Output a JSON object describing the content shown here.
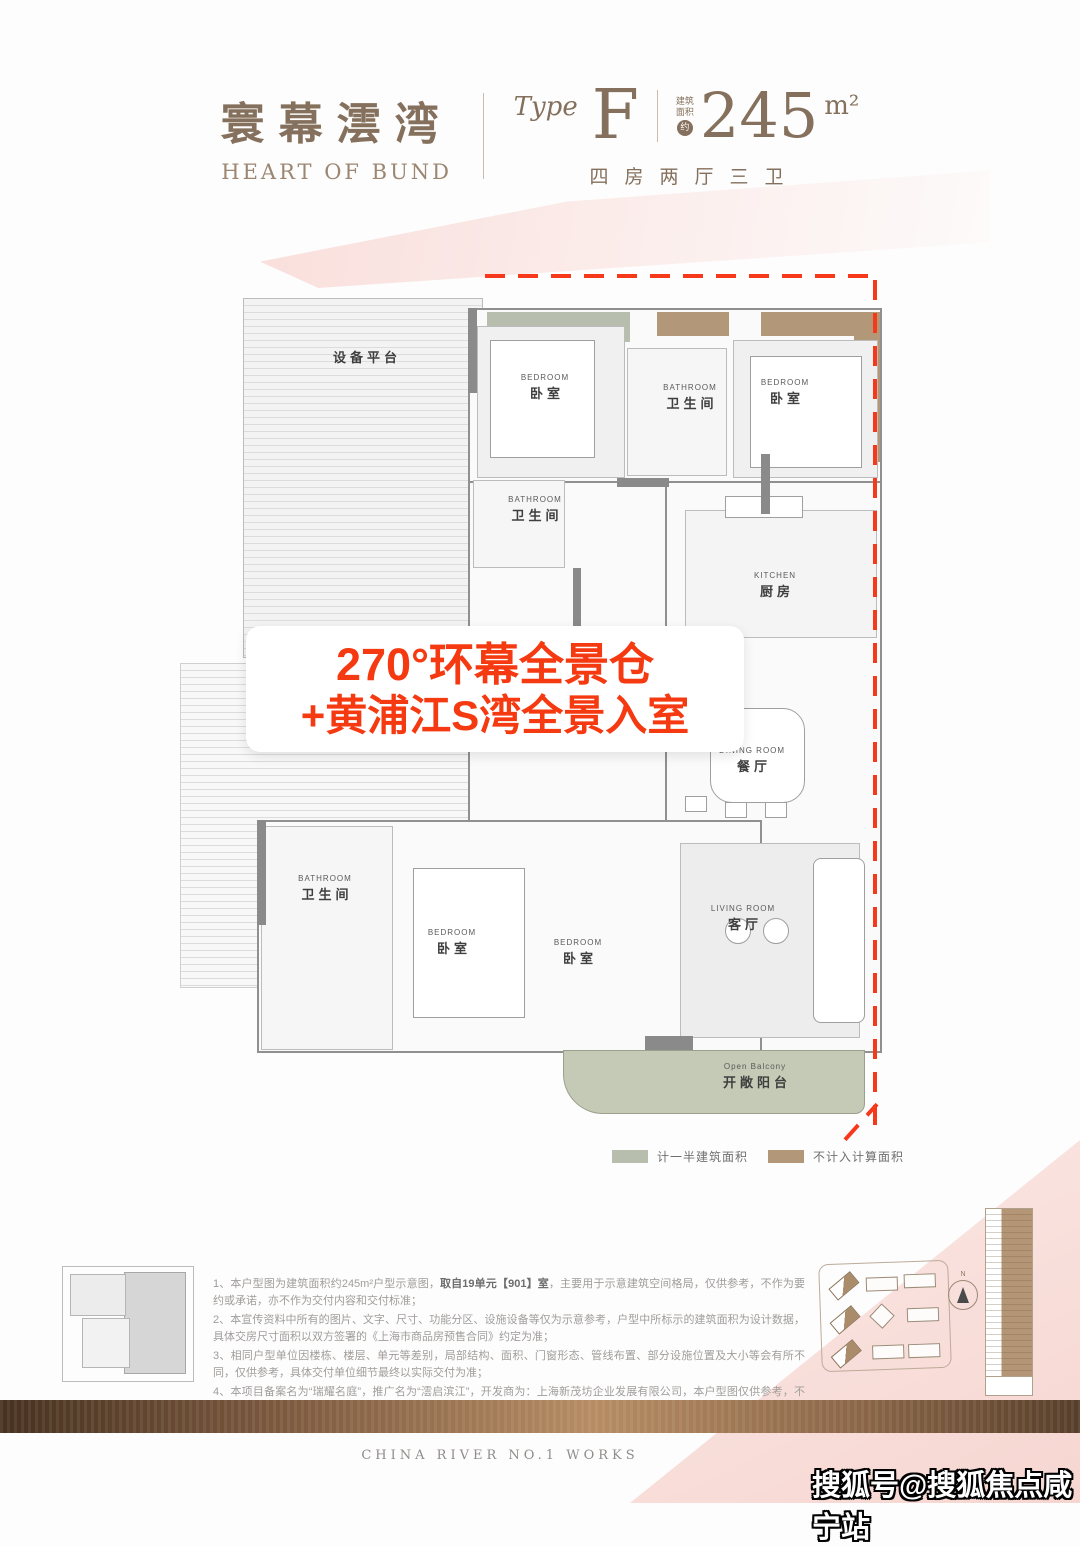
{
  "header": {
    "brand_cn": "寰幕澐湾",
    "brand_en": "HEART OF BUND",
    "type_label": "Type",
    "type_value": "F",
    "area_label_1": "建筑",
    "area_label_2": "面积",
    "area_approx": "约",
    "area_number": "245",
    "area_unit": "m²",
    "layout": "四房两厅三卫"
  },
  "banner": {
    "line1": "270°环幕全景仓",
    "line2": "+黄浦江S湾全景入室"
  },
  "floorplan": {
    "equipment_platform": "设备平台",
    "rooms": [
      {
        "id": "bedroom-top-left",
        "en": "BEDROOM",
        "cn": "卧室"
      },
      {
        "id": "bathroom-top",
        "en": "BATHROOM",
        "cn": "卫生间"
      },
      {
        "id": "bedroom-top-right",
        "en": "BEDROOM",
        "cn": "卧室"
      },
      {
        "id": "bathroom-mid",
        "en": "BATHROOM",
        "cn": "卫生间"
      },
      {
        "id": "kitchen",
        "en": "KITCHEN",
        "cn": "厨房"
      },
      {
        "id": "dining-room",
        "en": "DINING ROOM",
        "cn": "餐厅"
      },
      {
        "id": "living-room",
        "en": "LIVING ROOM",
        "cn": "客厅"
      },
      {
        "id": "bathroom-lower",
        "en": "BATHROOM",
        "cn": "卫生间"
      },
      {
        "id": "bedroom-lower-main",
        "en": "BEDROOM",
        "cn": "卧室"
      },
      {
        "id": "bedroom-lower-small",
        "en": "BEDROOM",
        "cn": "卧室"
      },
      {
        "id": "open-balcony",
        "en": "Open Balcony",
        "cn": "开敞阳台"
      }
    ]
  },
  "legend": {
    "items": [
      {
        "label": "计一半建筑面积",
        "color": "#b7bead"
      },
      {
        "label": "不计入计算面积",
        "color": "#b29879"
      }
    ]
  },
  "colors": {
    "accent_red": "#f53a12",
    "brand_brown": "#84705c",
    "half_area_green": "#b7bead",
    "excluded_brown": "#b29879",
    "balcony_green": "#c4cab5"
  },
  "disclaimer": {
    "l1a": "1、本户型图为建筑面积约245m²户型示意图，",
    "l1b": "取自19单元【901】室",
    "l1c": "，主要用于示意建筑空间格局，仅供参考，不作为要约或承诺，亦不作为交付内容和交付标准；",
    "l2": "2、本宣传资料中所有的图片、文字、尺寸、功能分区、设施设备等仅为示意参考，户型中所标示的建筑面积为设计数据，具体交房尺寸面积以双方签署的《上海市商品房预售合同》约定为准；",
    "l3": "3、相同户型单位因楼栋、楼层、单元等差别，局部结构、面积、门窗形态、管线布置、部分设施位置及大小等会有所不同，仅供参考，具体交付单位细节最终以实际交付为准；",
    "l4": "4、本项目备案名为“瑞耀名庭”，推广名为“澐启滨江”，开发商为：上海新茂坊企业发展有限公司，本户型图仅供参考，不作为要约邀请，相关内容不排除因政府相关规划、规定及开发商未能知晓的原因而发生变化，本公司保留对宣传资料修改的权利,敬请留意最新资料。本户型图制作时间为2025年10月。"
  },
  "footer": {
    "slogan": "CHINA RIVER NO.1 WORKS"
  },
  "watermark": {
    "text": "搜狐号@搜狐焦点咸宁站"
  }
}
